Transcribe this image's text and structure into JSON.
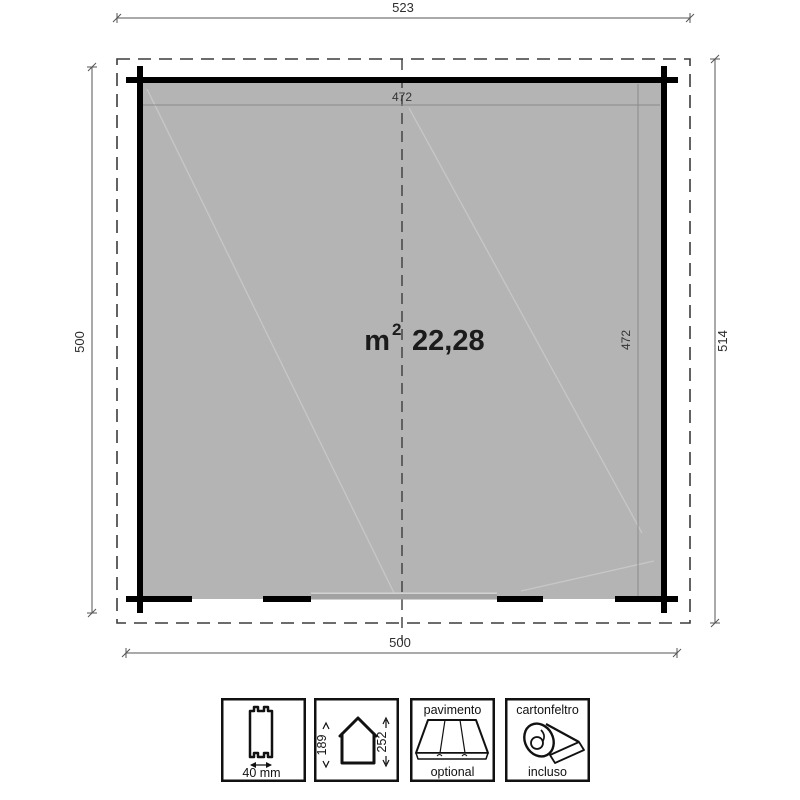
{
  "plan": {
    "area": {
      "unit_base": "m",
      "unit_exp": "2",
      "value": "22,28"
    },
    "dimensions": {
      "top": "523",
      "bottom": "500",
      "left": "500",
      "right": "514",
      "inner_width": "472",
      "inner_depth": "472"
    },
    "colors": {
      "floor_fill": "#b4b4b4",
      "wall": "#000000",
      "dashed_outline": "#3c3c3c",
      "dimension_line": "#555555",
      "inner_dimension_line": "#8a8a8a",
      "door_bar": "#a2a2a2"
    }
  },
  "legend": {
    "boxes": [
      {
        "id": "wall-thickness",
        "icon": "wall-profile-icon",
        "label": "40 mm"
      },
      {
        "id": "house-heights",
        "icon": "house-icon",
        "side_height": "189",
        "ridge_height": "252"
      },
      {
        "id": "floor",
        "icon": "floor-boards-icon",
        "top_label": "pavimento",
        "bottom_label": "optional"
      },
      {
        "id": "roof-felt",
        "icon": "felt-roll-icon",
        "top_label": "cartonfeltro",
        "bottom_label": "incluso"
      }
    ]
  }
}
